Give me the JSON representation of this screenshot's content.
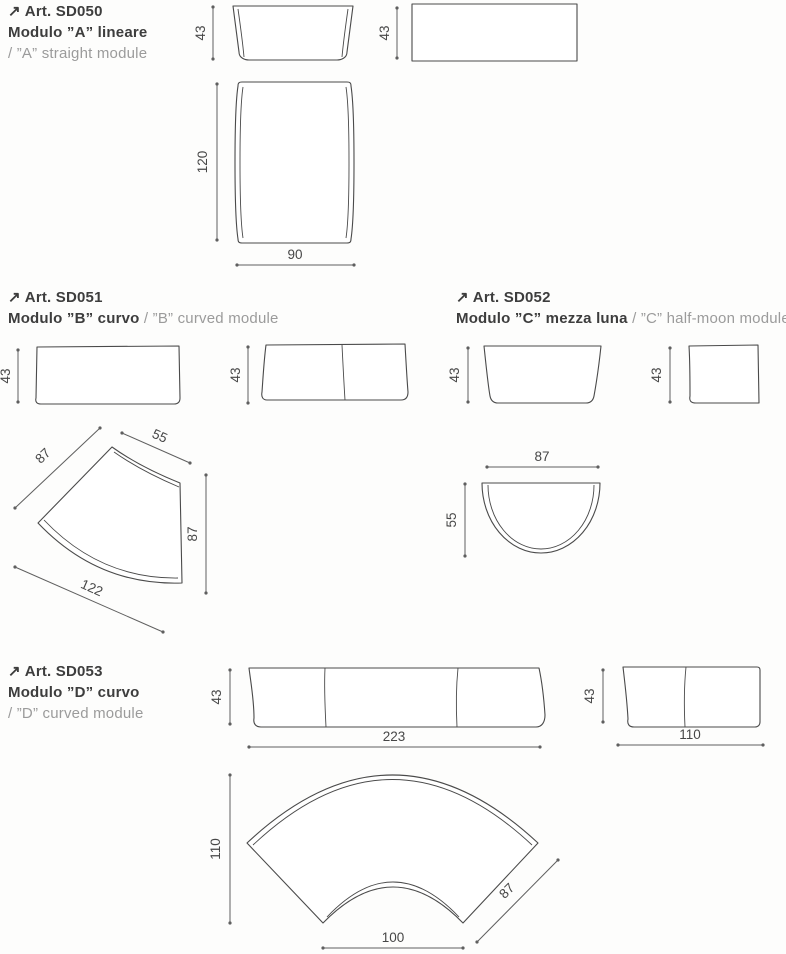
{
  "arrow_glyph": "↗",
  "colors": {
    "ink": "#3d3d3d",
    "muted": "#9b9b9b",
    "line": "#4a4a4a"
  },
  "articles": [
    {
      "code": "Art. SD050",
      "title_it": "Modulo ”A” lineare",
      "title_en": "/ ”A” straight module",
      "dims": {
        "front_height": "43",
        "side_height": "43",
        "plan_depth": "120",
        "plan_width": "90"
      }
    },
    {
      "code": "Art. SD051",
      "title_it": "Modulo ”B” curvo",
      "title_en": "/ ”B” curved module",
      "dims": {
        "side_height": "43",
        "front_height": "43",
        "fan_back": "87",
        "fan_inner": "55",
        "fan_side": "87",
        "fan_outer": "122"
      }
    },
    {
      "code": "Art. SD052",
      "title_it": "Modulo ”C” mezza luna",
      "title_en": "/ ”C” half-moon module",
      "dims": {
        "front_height": "43",
        "side_height": "43",
        "plan_width": "87",
        "plan_depth": "55"
      }
    },
    {
      "code": "Art. SD053",
      "title_it": "Modulo ”D” curvo",
      "title_en": "/ ”D” curved module",
      "dims": {
        "front_height": "43",
        "front_width": "223",
        "side_height": "43",
        "side_width": "110",
        "fan_height": "110",
        "fan_side": "87",
        "fan_inner": "100"
      }
    }
  ]
}
